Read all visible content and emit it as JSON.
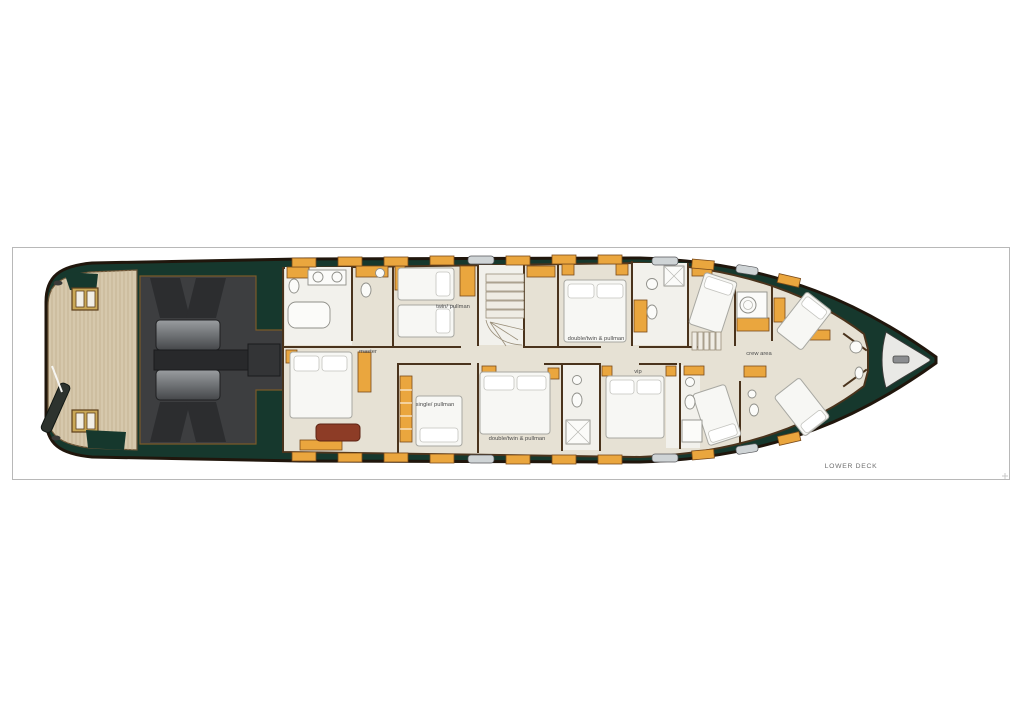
{
  "plan": {
    "deck_label": "LOWER DECK",
    "cabins": [
      {
        "id": "master",
        "label": "master"
      },
      {
        "id": "twin-pullman",
        "label": "twin/ pullman"
      },
      {
        "id": "double-twin-pullman-starboard",
        "label": "double/twin & pullman"
      },
      {
        "id": "double-twin-pullman-port",
        "label": "double/twin & pullman"
      },
      {
        "id": "single-pullman",
        "label": "single/ pullman"
      },
      {
        "id": "vip",
        "label": "vip"
      },
      {
        "id": "crew-area",
        "label": "crew area"
      }
    ],
    "colors": {
      "hull_outline": "#20160c",
      "deck_green": "#16382d",
      "teak": "#d6c8ac",
      "teak_line": "#bdab8a",
      "floor_beige": "#e6e1d4",
      "bath_floor": "#f2f1ec",
      "furniture_orange": "#eaa63e",
      "wood_trim": "#7a4a1a",
      "wall_brown": "#4a331c",
      "engine_room": "#3d3e40",
      "engine_gray": "#84878a",
      "bed_white": "#f7f7f4",
      "couch_red": "#8d3c26",
      "window_gray": "#cfd4d6",
      "label_gray": "#4d4d4d",
      "panel_border": "#b8b8b8"
    }
  }
}
